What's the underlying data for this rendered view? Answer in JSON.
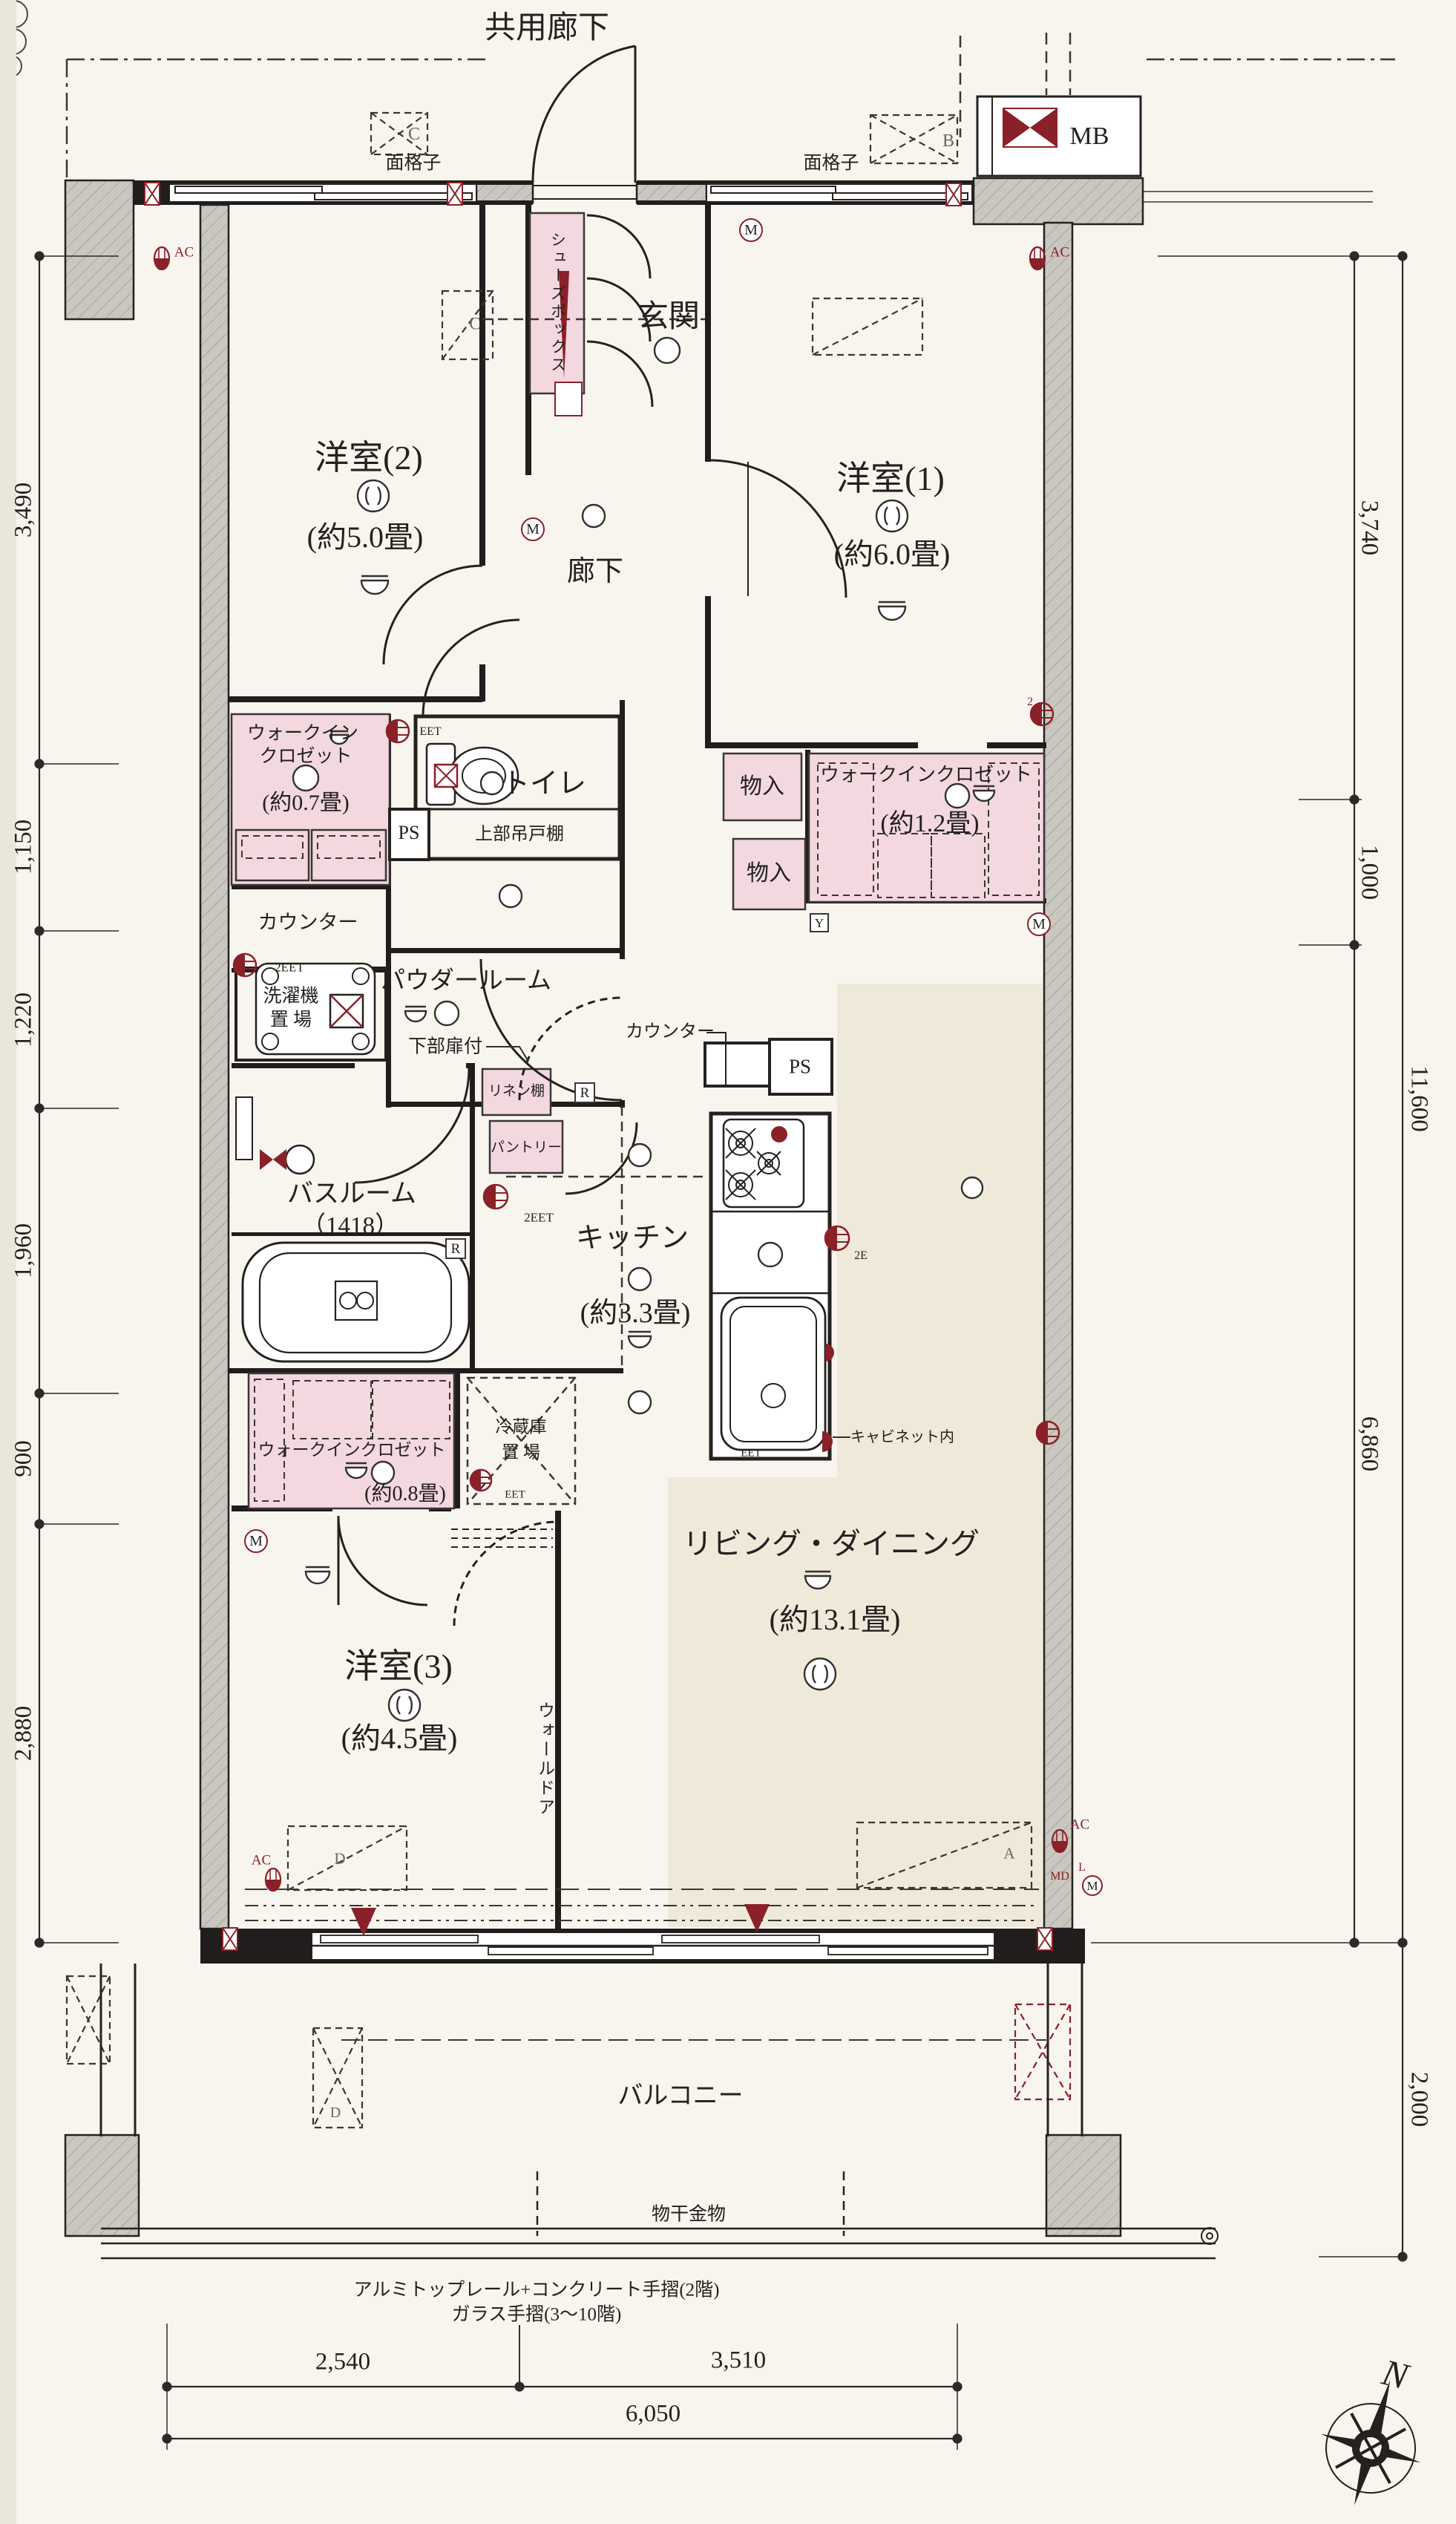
{
  "colors": {
    "paper": "#f8f5ee",
    "pink": "#f3d8e0",
    "beige": "#efe9da",
    "gray": "#cac7c0",
    "maroon": "#8a2028",
    "ink": "#24211f"
  },
  "corridor_label": "共用廊下",
  "meter_box": {
    "label": "MB"
  },
  "grilles": {
    "left": "面格子",
    "right": "面格子"
  },
  "entrance": {
    "name": "玄関",
    "shoe_box": "シューズボックス"
  },
  "rooms": {
    "western2": {
      "name": "洋室(2)",
      "size": "(約5.0畳)"
    },
    "western1": {
      "name": "洋室(1)",
      "size": "(約6.0畳)"
    },
    "western3": {
      "name": "洋室(3)",
      "size": "(約4.5畳)"
    },
    "living_dining": {
      "name": "リビング・ダイニング",
      "size": "(約13.1畳)"
    },
    "kitchen": {
      "name": "キッチン",
      "size": "(約3.3畳)"
    },
    "hallway": {
      "name": "廊下"
    },
    "toilet": {
      "name": "トイレ",
      "upper_cabinet": "上部吊戸棚"
    },
    "powder": {
      "name": "パウダールーム",
      "lower_door": "下部扉付"
    },
    "bathroom": {
      "name": "バスルーム",
      "size": "（1418）"
    },
    "wic07": {
      "line1": "ウォークイン",
      "line2": "クロゼット",
      "size": "(約0.7畳)"
    },
    "wic12": {
      "name": "ウォークインクロゼット",
      "size": "(約1.2畳)"
    },
    "wic08": {
      "name": "ウォークインクロゼット",
      "size": "(約0.8畳)"
    },
    "laundry": {
      "line1": "洗濯機",
      "line2": "置 場"
    },
    "fridge": {
      "line1": "冷蔵庫",
      "line2": "置 場"
    },
    "storage": "物入",
    "linen": "リネン棚",
    "pantry": "パントリー",
    "counter_wash": "カウンター",
    "counter_kitchen": "カウンター",
    "cabinet_note": "キャビネット内",
    "wall_door": "ウォールドア"
  },
  "balcony": {
    "name": "バルコニー",
    "hardware": "物干金物",
    "note1": "アルミトップレール+コンクリート手摺(2階)",
    "note2": "ガラス手摺(3～10階)"
  },
  "dimensions": {
    "left": [
      "3,490",
      "1,150",
      "1,220",
      "1,960",
      "900",
      "2,880"
    ],
    "right": [
      "3,740",
      "1,000",
      "6,860"
    ],
    "right_outer": [
      "11,600",
      "2,000"
    ],
    "bottom": [
      "2,540",
      "3,510"
    ],
    "bottom_total": "6,050"
  },
  "markers": {
    "ps": "PS",
    "r": "R",
    "m": "M",
    "y": "Y",
    "t": "t",
    "d": "D",
    "c": "C",
    "b": "B",
    "a": "A",
    "ac": "AC",
    "md": "MD",
    "l": "L",
    "eet": "EET",
    "eet2": "2EET",
    "e2": "2E",
    "two": "2",
    "north": "N"
  }
}
